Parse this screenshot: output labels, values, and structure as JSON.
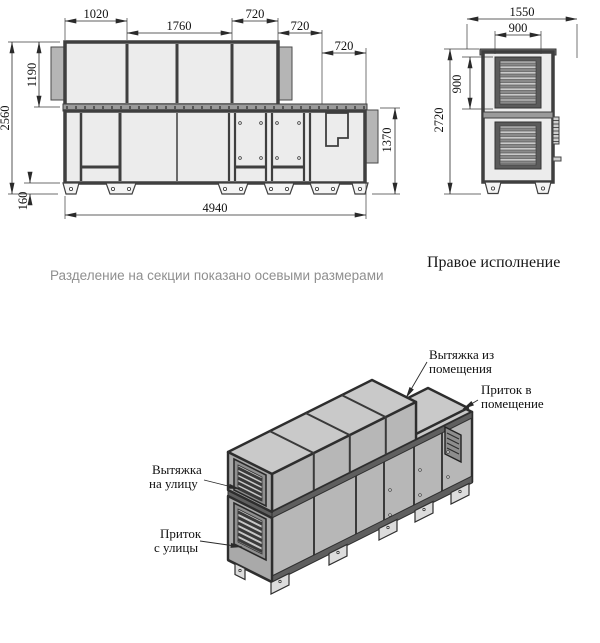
{
  "note": "Разделение на секции показано осевыми размерами",
  "front_view": {
    "dim_1020": "1020",
    "dim_1760": "1760",
    "dim_720_top": "720",
    "dim_720_mid": "720",
    "dim_720_low": "720",
    "dim_2560": "2560",
    "dim_1190": "1190",
    "dim_160": "160",
    "dim_4940": "4940",
    "dim_1370": "1370"
  },
  "side_view": {
    "caption": "Правое исполнение",
    "dim_1550": "1550",
    "dim_900_width": "900",
    "dim_900_height": "900",
    "dim_2720": "2720"
  },
  "iso_view": {
    "labels": {
      "exhaust_from_room": {
        "line1": "Вытяжка из",
        "line2": "помещения"
      },
      "supply_to_room": {
        "line1": "Приток в",
        "line2": "помещение"
      },
      "exhaust_to_outside": {
        "line1": "Вытяжка",
        "line2": "на улицу"
      },
      "supply_from_outside": {
        "line1": "Приток",
        "line2": "с улицы"
      }
    }
  },
  "colors": {
    "frame": "#3f3f3f",
    "panel": "#ececec",
    "iso_top_face": "#c9c9c9",
    "iso_front_face": "#b7b7b7",
    "iso_end_face": "#a9a9a9",
    "note_text": "#8f8f8f",
    "dimension_lines": "#2a2a2a"
  }
}
